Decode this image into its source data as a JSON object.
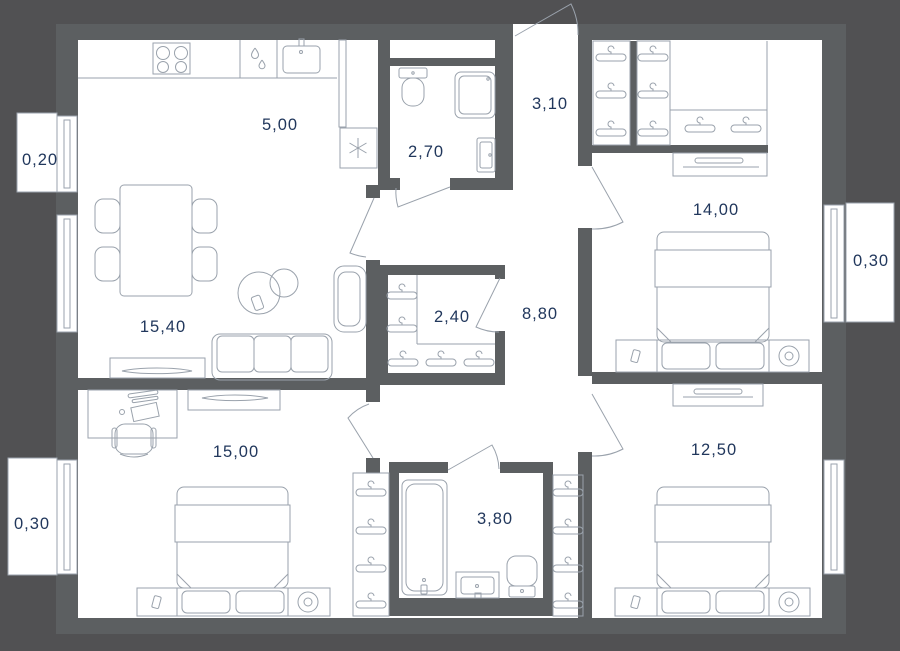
{
  "plan": {
    "colors": {
      "background-color": "#515153",
      "wall-color": "#5c5f61",
      "room-fill": "#ffffff",
      "line-color": "#9aa2ac",
      "label-color": "#21375c"
    },
    "rooms": [
      {
        "name": "kitchen",
        "area": "5,00"
      },
      {
        "name": "bathroom-small",
        "area": "2,70"
      },
      {
        "name": "entrance-hall",
        "area": "3,10"
      },
      {
        "name": "bedroom-top-right",
        "area": "14,00"
      },
      {
        "name": "balcony-top-left",
        "area": "0,20"
      },
      {
        "name": "balcony-right",
        "area": "0,30"
      },
      {
        "name": "living-room",
        "area": "15,40"
      },
      {
        "name": "closet",
        "area": "2,40"
      },
      {
        "name": "hallway",
        "area": "8,80"
      },
      {
        "name": "bedroom-bottom-left",
        "area": "15,00"
      },
      {
        "name": "balcony-bottom-left",
        "area": "0,30"
      },
      {
        "name": "bathroom-large",
        "area": "3,80"
      },
      {
        "name": "bedroom-bottom-right",
        "area": "12,50"
      }
    ]
  }
}
